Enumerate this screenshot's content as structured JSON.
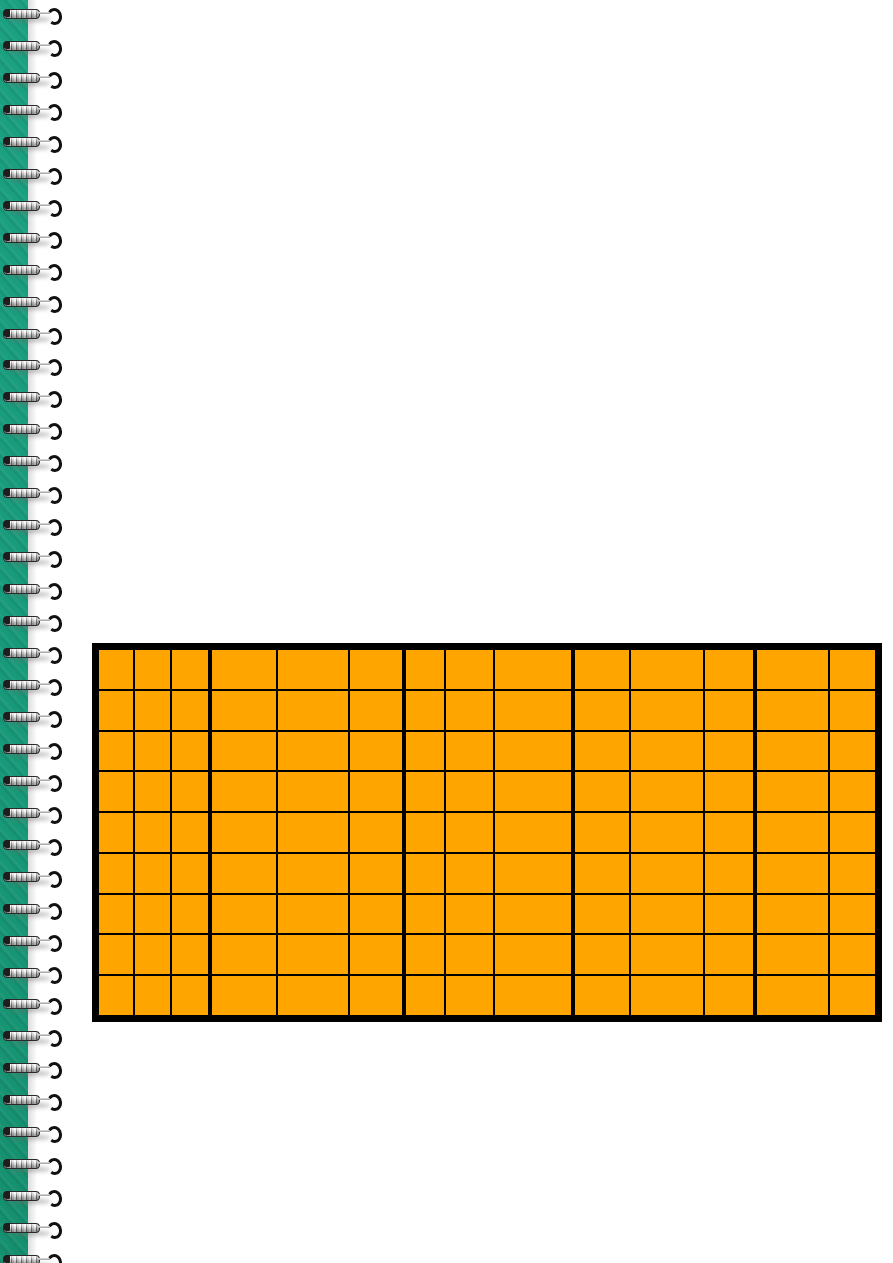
{
  "page": {
    "width_px": 893,
    "height_px": 1263,
    "background_color": "#FFFFFF",
    "description": "Spiral-bound notebook page with an empty orange grid table"
  },
  "binding": {
    "strip_color": "#189A7A",
    "strip_width_px": 28,
    "coil_count": 40,
    "coil_first_top_px": 8,
    "coil_spacing_px": 31.95,
    "wire_color": "#C9C9C9",
    "hook_color": "#101010"
  },
  "table": {
    "left_px": 92,
    "top_px": 643,
    "width_px": 790,
    "height_px": 379,
    "fill_color": "#FFA500",
    "grid_line_color": "#000000",
    "outer_border_px": 7,
    "thin_line_px": 2,
    "thick_line_px": 4,
    "rows": 9,
    "columns": 14,
    "column_widths_ratio": [
      35,
      36,
      38,
      68,
      72,
      54,
      41,
      49,
      78,
      58,
      74,
      50,
      76,
      46
    ],
    "thick_separator_before_columns": [
      3,
      6,
      9,
      12
    ],
    "cell_text": ""
  }
}
